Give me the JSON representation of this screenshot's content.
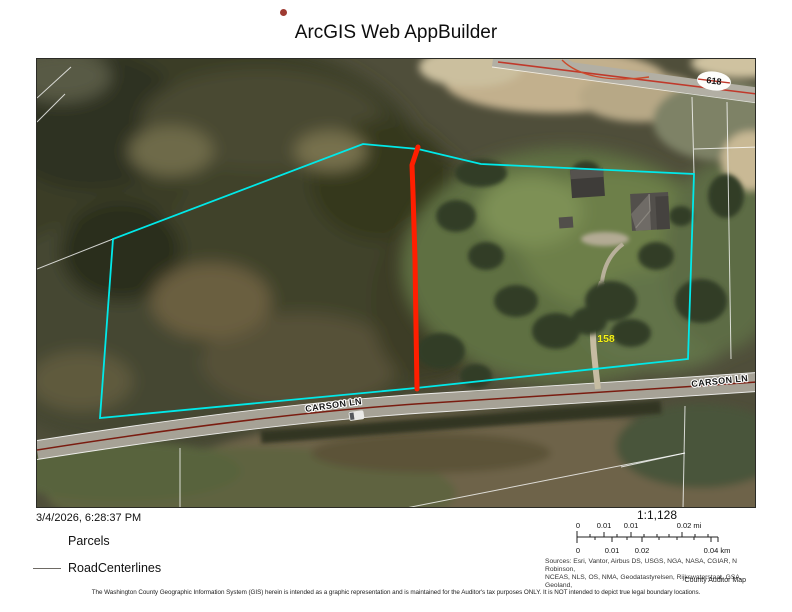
{
  "header": {
    "title": "ArcGIS Web AppBuilder",
    "status_dot_color": "#9e3a32"
  },
  "map": {
    "labels": {
      "road_label_left": "CARSON LN",
      "road_label_right": "CARSON LN",
      "route_shield": "618",
      "parcel_number": "158"
    },
    "colors": {
      "parcel_outline": "#00e9e9",
      "highlight_line": "#ff1e00",
      "road_centerline": "#7a1c10",
      "parcel_number_label": "#f5f318"
    }
  },
  "footer": {
    "timestamp": "3/4/2026, 6:28:37 PM",
    "legend": {
      "items": [
        {
          "label": "Parcels"
        },
        {
          "label": "RoadCenterlines"
        }
      ]
    },
    "scale": {
      "ratio": "1:1,128",
      "mi": [
        "0",
        "0.01",
        "0.01",
        "0.02 mi"
      ],
      "km": [
        "0",
        "0.01",
        "0.02",
        "0.04 km"
      ]
    },
    "sources": [
      "Sources: Esri, Vantor, Airbus DS, USGS, NGA, NASA, CGIAR, N Robinson,",
      "NCEAS, NLS, OS, NMA, Geodatastyrelsen, Rijkswaterstaat, GSA, Geoland,"
    ],
    "credit": "County Auditor Map",
    "disclaimer": "The Washington County Geographic Information System (GIS) herein is intended as a graphic representation and is maintained for the Auditor's tax purposes ONLY. It is NOT intended to depict true legal boundary locations."
  }
}
